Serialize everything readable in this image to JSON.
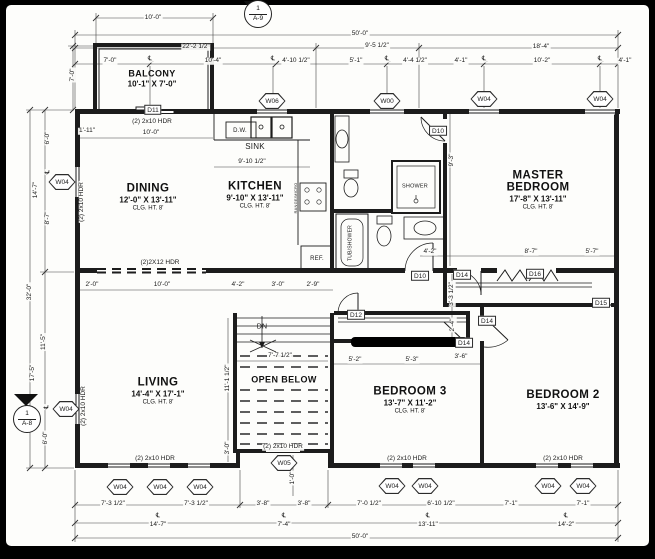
{
  "markers": {
    "a9": {
      "number": "1",
      "sheet": "A-9"
    },
    "a8": {
      "number": "1",
      "sheet": "A-8"
    }
  },
  "rooms": [
    {
      "name": "BALCONY",
      "size": "10'-1\" X 7'-0\"",
      "clg": "",
      "x": 152,
      "y": 79,
      "small": true
    },
    {
      "name": "DINING",
      "size": "12'-0\" X 13'-11\"",
      "clg": "CLG. HT. 8'",
      "x": 148,
      "y": 197
    },
    {
      "name": "KITCHEN",
      "size": "9'-10\" X 13'-11\"",
      "clg": "CLG. HT. 8'",
      "x": 255,
      "y": 195
    },
    {
      "name": "MASTER BEDROOM",
      "size": "17'-8\" X 13'-11\"",
      "clg": "CLG. HT. 8'",
      "x": 538,
      "y": 190,
      "wrap": true
    },
    {
      "name": "LIVING",
      "size": "14'-4\" X 17'-1\"",
      "clg": "CLG. HT. 8'",
      "x": 158,
      "y": 391
    },
    {
      "name": "OPEN BELOW",
      "size": "",
      "clg": "",
      "x": 284,
      "y": 380,
      "small": true
    },
    {
      "name": "BEDROOM 3",
      "size": "13'-7\" X 11'-2\"",
      "clg": "CLG. HT. 8'",
      "x": 410,
      "y": 400
    },
    {
      "name": "BEDROOM 2",
      "size": "13'-6\" X 14'-9\"",
      "clg": "",
      "x": 563,
      "y": 400
    }
  ],
  "fixtures": [
    {
      "t": "D.W.",
      "x": 240,
      "y": 131,
      "size": 6
    },
    {
      "t": "SINK",
      "x": 255,
      "y": 147,
      "size": 8
    },
    {
      "t": "REF.",
      "x": 317,
      "y": 259,
      "size": 6
    },
    {
      "t": "SHOWER",
      "x": 415,
      "y": 187,
      "size": 5.5
    },
    {
      "t": "TUB/SHOWER",
      "x": 351,
      "y": 243,
      "size": 5,
      "rot": true
    },
    {
      "t": "RANGE/MICRO",
      "x": 296,
      "y": 198,
      "size": 4,
      "rot": true
    },
    {
      "t": "DN",
      "x": 262,
      "y": 327,
      "size": 7
    }
  ],
  "window_tags": [
    {
      "label": "W06",
      "x": 272,
      "y": 101
    },
    {
      "label": "W00",
      "x": 387,
      "y": 101
    },
    {
      "label": "W04",
      "x": 484,
      "y": 99
    },
    {
      "label": "W04",
      "x": 600,
      "y": 99
    },
    {
      "label": "W04",
      "x": 62,
      "y": 182
    },
    {
      "label": "W04",
      "x": 66,
      "y": 409
    },
    {
      "label": "W04",
      "x": 120,
      "y": 487
    },
    {
      "label": "W04",
      "x": 160,
      "y": 487
    },
    {
      "label": "W04",
      "x": 200,
      "y": 487
    },
    {
      "label": "W05",
      "x": 284,
      "y": 463
    },
    {
      "label": "W04",
      "x": 392,
      "y": 486
    },
    {
      "label": "W04",
      "x": 425,
      "y": 486
    },
    {
      "label": "W04",
      "x": 548,
      "y": 486
    },
    {
      "label": "W04",
      "x": 583,
      "y": 486
    }
  ],
  "door_tags": [
    {
      "label": "D11",
      "x": 153,
      "y": 110
    },
    {
      "label": "D10",
      "x": 438,
      "y": 131
    },
    {
      "label": "D10",
      "x": 420,
      "y": 276
    },
    {
      "label": "D14",
      "x": 462,
      "y": 275
    },
    {
      "label": "D16",
      "x": 535,
      "y": 274
    },
    {
      "label": "D12",
      "x": 356,
      "y": 315
    },
    {
      "label": "D14",
      "x": 487,
      "y": 321
    },
    {
      "label": "D14",
      "x": 464,
      "y": 343
    },
    {
      "label": "D15",
      "x": 601,
      "y": 303
    }
  ],
  "headers": [
    {
      "t": "(2) 2x10 HDR",
      "x": 152,
      "y": 122
    },
    {
      "t": "(2) 2x10 HDR",
      "x": 82,
      "y": 202,
      "rot": true
    },
    {
      "t": "(2) 2x10 HDR",
      "x": 84,
      "y": 406,
      "rot": true
    },
    {
      "t": "(2)2X12 HDR",
      "x": 160,
      "y": 263
    },
    {
      "t": "(2) 2x10 HDR",
      "x": 155,
      "y": 459
    },
    {
      "t": "(2) 2x10 HDR",
      "x": 283,
      "y": 447
    },
    {
      "t": "(2) 2x10 HDR",
      "x": 407,
      "y": 459
    },
    {
      "t": "(2) 2x10 HDR",
      "x": 563,
      "y": 459
    }
  ],
  "dims": [
    {
      "t": "10'-0\"",
      "x": 153,
      "y": 18
    },
    {
      "t": "22'-2 1/2\"",
      "x": 196,
      "y": 47
    },
    {
      "t": "50'-0\"",
      "x": 360,
      "y": 34
    },
    {
      "t": "9'-5 1/2\"",
      "x": 377,
      "y": 46
    },
    {
      "t": "18'-4\"",
      "x": 541,
      "y": 47
    },
    {
      "t": "7'-0\"",
      "x": 110,
      "y": 61
    },
    {
      "t": "℄",
      "x": 150,
      "y": 59
    },
    {
      "t": "10'-4\"",
      "x": 213,
      "y": 61
    },
    {
      "t": "℄",
      "x": 273,
      "y": 59
    },
    {
      "t": "4'-10 1/2\"",
      "x": 296,
      "y": 61
    },
    {
      "t": "5'-1\"",
      "x": 356,
      "y": 61
    },
    {
      "t": "℄",
      "x": 387,
      "y": 59
    },
    {
      "t": "4'-4 1/2\"",
      "x": 415,
      "y": 61
    },
    {
      "t": "4'-1\"",
      "x": 461,
      "y": 61
    },
    {
      "t": "℄",
      "x": 484,
      "y": 59
    },
    {
      "t": "10'-2\"",
      "x": 542,
      "y": 61
    },
    {
      "t": "℄",
      "x": 600,
      "y": 59
    },
    {
      "t": "4'-1\"",
      "x": 625,
      "y": 61
    },
    {
      "t": "7'-0\"",
      "x": 73,
      "y": 75,
      "rot": true
    },
    {
      "t": "6'-0\"",
      "x": 48,
      "y": 138,
      "rot": true
    },
    {
      "t": "℄",
      "x": 48,
      "y": 172,
      "rot": true
    },
    {
      "t": "14'-7\"",
      "x": 36,
      "y": 190,
      "rot": true
    },
    {
      "t": "8'-7\"",
      "x": 48,
      "y": 218,
      "rot": true
    },
    {
      "t": "32'-0\"",
      "x": 30,
      "y": 292,
      "rot": true
    },
    {
      "t": "11'-5\"",
      "x": 44,
      "y": 342,
      "rot": true
    },
    {
      "t": "17'-5\"",
      "x": 33,
      "y": 373,
      "rot": true
    },
    {
      "t": "℄",
      "x": 47,
      "y": 407,
      "rot": true
    },
    {
      "t": "6'-0\"",
      "x": 46,
      "y": 438,
      "rot": true
    },
    {
      "t": "1'-11\"",
      "x": 87,
      "y": 131
    },
    {
      "t": "10'-0\"",
      "x": 151,
      "y": 133
    },
    {
      "t": "9'-10 1/2\"",
      "x": 252,
      "y": 162
    },
    {
      "t": "2'-0\"",
      "x": 92,
      "y": 285
    },
    {
      "t": "10'-0\"",
      "x": 162,
      "y": 285
    },
    {
      "t": "4'-2\"",
      "x": 238,
      "y": 285
    },
    {
      "t": "3'-0\"",
      "x": 278,
      "y": 285
    },
    {
      "t": "2'-9\"",
      "x": 313,
      "y": 285
    },
    {
      "t": "4'-2\"",
      "x": 430,
      "y": 252
    },
    {
      "t": "8'-7\"",
      "x": 531,
      "y": 252
    },
    {
      "t": "5'-7\"",
      "x": 592,
      "y": 252
    },
    {
      "t": "9'-3\"",
      "x": 452,
      "y": 160,
      "rot": true
    },
    {
      "t": "3'-3 1/2\"",
      "x": 452,
      "y": 294,
      "rot": true
    },
    {
      "t": "2'-4\"",
      "x": 453,
      "y": 325,
      "rot": true
    },
    {
      "t": "5'-2\"",
      "x": 355,
      "y": 360
    },
    {
      "t": "5'-3\"",
      "x": 412,
      "y": 360
    },
    {
      "t": "3'-6\"",
      "x": 461,
      "y": 357
    },
    {
      "t": "7'-7 1/2\"",
      "x": 280,
      "y": 356
    },
    {
      "t": "11'-1 1/2\"",
      "x": 228,
      "y": 378,
      "rot": true
    },
    {
      "t": "3'-0\"",
      "x": 228,
      "y": 448,
      "rot": true
    },
    {
      "t": "1'-0\"",
      "x": 293,
      "y": 478,
      "rot": true
    },
    {
      "t": "7'-3 1/2\"",
      "x": 113,
      "y": 504
    },
    {
      "t": "7'-3 1/2\"",
      "x": 196,
      "y": 504
    },
    {
      "t": "3'-8\"",
      "x": 263,
      "y": 504
    },
    {
      "t": "3'-8\"",
      "x": 304,
      "y": 504
    },
    {
      "t": "7'-0 1/2\"",
      "x": 369,
      "y": 504
    },
    {
      "t": "6'-10 1/2\"",
      "x": 441,
      "y": 504
    },
    {
      "t": "7'-1\"",
      "x": 511,
      "y": 504
    },
    {
      "t": "7'-1\"",
      "x": 583,
      "y": 504
    },
    {
      "t": "℄",
      "x": 158,
      "y": 516
    },
    {
      "t": "14'-7\"",
      "x": 158,
      "y": 525
    },
    {
      "t": "℄",
      "x": 284,
      "y": 516
    },
    {
      "t": "7'-4\"",
      "x": 284,
      "y": 525
    },
    {
      "t": "℄",
      "x": 428,
      "y": 516
    },
    {
      "t": "13'-11\"",
      "x": 428,
      "y": 525
    },
    {
      "t": "℄",
      "x": 566,
      "y": 516
    },
    {
      "t": "14'-2\"",
      "x": 566,
      "y": 525
    },
    {
      "t": "50'-0\"",
      "x": 360,
      "y": 537
    }
  ]
}
